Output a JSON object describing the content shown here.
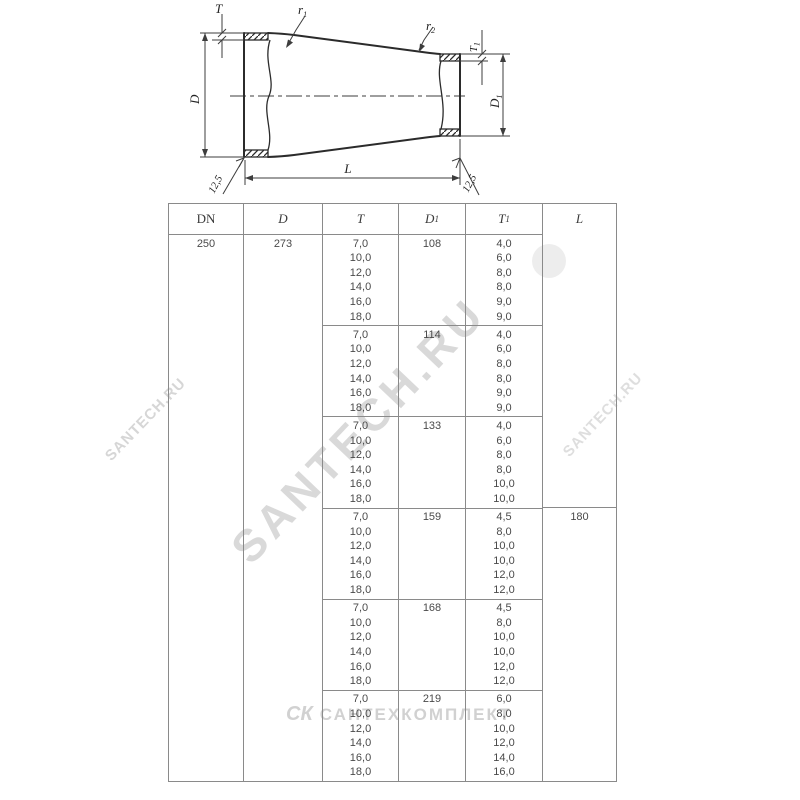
{
  "drawing": {
    "labels": {
      "T": "T",
      "D": "D",
      "L": "L",
      "r1": {
        "base": "r",
        "sub": "1"
      },
      "r2": {
        "base": "r",
        "sub": "2"
      },
      "T1": {
        "base": "T",
        "sub": "1"
      },
      "D1": {
        "base": "D",
        "sub": "1"
      },
      "chamfer_left": "12,5",
      "chamfer_right": "12,5"
    }
  },
  "table": {
    "headers": [
      {
        "base": "DN",
        "sub": ""
      },
      {
        "base": "D",
        "sub": ""
      },
      {
        "base": "T",
        "sub": ""
      },
      {
        "base": "D",
        "sub": "1"
      },
      {
        "base": "T",
        "sub": "1"
      },
      {
        "base": "L",
        "sub": ""
      }
    ],
    "dn": "250",
    "d": "273",
    "l": "180",
    "groups": [
      {
        "d1": "108",
        "t": [
          "7,0",
          "10,0",
          "12,0",
          "14,0",
          "16,0",
          "18,0"
        ],
        "t1": [
          "4,0",
          "6,0",
          "8,0",
          "8,0",
          "9,0",
          "9,0"
        ]
      },
      {
        "d1": "114",
        "t": [
          "7,0",
          "10,0",
          "12,0",
          "14,0",
          "16,0",
          "18,0"
        ],
        "t1": [
          "4,0",
          "6,0",
          "8,0",
          "8,0",
          "9,0",
          "9,0"
        ]
      },
      {
        "d1": "133",
        "t": [
          "7,0",
          "10,0",
          "12,0",
          "14,0",
          "16,0",
          "18,0"
        ],
        "t1": [
          "4,0",
          "6,0",
          "8,0",
          "8,0",
          "10,0",
          "10,0"
        ]
      },
      {
        "d1": "159",
        "t": [
          "7,0",
          "10,0",
          "12,0",
          "14,0",
          "16,0",
          "18,0"
        ],
        "t1": [
          "4,5",
          "8,0",
          "10,0",
          "10,0",
          "12,0",
          "12,0"
        ]
      },
      {
        "d1": "168",
        "t": [
          "7,0",
          "10,0",
          "12,0",
          "14,0",
          "16,0",
          "18,0"
        ],
        "t1": [
          "4,5",
          "8,0",
          "10,0",
          "10,0",
          "12,0",
          "12,0"
        ]
      },
      {
        "d1": "219",
        "t": [
          "7,0",
          "10,0",
          "12,0",
          "14,0",
          "16,0",
          "18,0"
        ],
        "t1": [
          "6,0",
          "8,0",
          "10,0",
          "12,0",
          "14,0",
          "16,0"
        ]
      }
    ]
  },
  "watermarks": {
    "diagonal_left": "SANTECH.RU",
    "diagonal_center": "SANTECH.RU",
    "diagonal_right": "SANTECH.RU",
    "bottom_logo": "СК",
    "bottom_text": "САНТЕХКОМПЛЕКТ"
  }
}
